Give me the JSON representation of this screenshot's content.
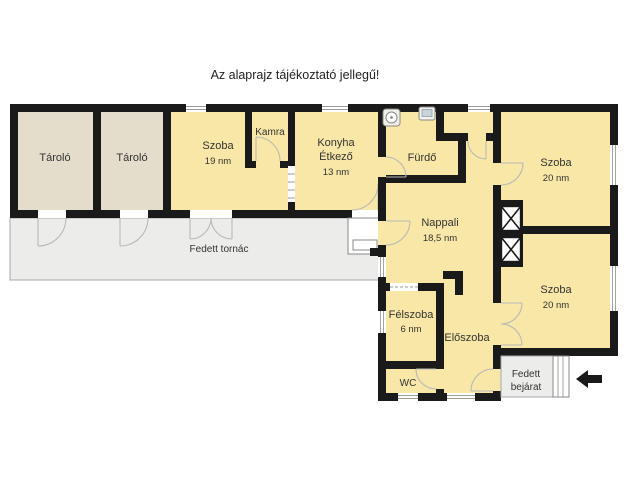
{
  "title": "Az alaprajz tájékoztató jellegű!",
  "colors": {
    "wall": "#1a1a1a",
    "room_yellow": "#f8e7a6",
    "storage_beige": "#e4ddcc",
    "covered_grey": "#ececea",
    "outline_grey": "#a9a9a9",
    "background": "#ffffff"
  },
  "rooms": {
    "tarolo_a": {
      "name": "Tároló"
    },
    "tarolo_b": {
      "name": "Tároló"
    },
    "szoba_19": {
      "name": "Szoba",
      "area": "19 nm"
    },
    "kamra": {
      "name": "Kamra"
    },
    "konyha": {
      "line1": "Konyha",
      "line2": "Étkező",
      "line3": "13 nm"
    },
    "furdo": {
      "name": "Fürdő"
    },
    "szoba_felso": {
      "name": "Szoba",
      "area": "20 nm"
    },
    "nappali": {
      "name": "Nappali",
      "area": "18,5 nm"
    },
    "szoba_also": {
      "name": "Szoba",
      "area": "20 nm"
    },
    "felszoba": {
      "name": "Félszoba",
      "area": "6 nm"
    },
    "eloszoba": {
      "name": "Előszoba"
    },
    "wc": {
      "name": "WC"
    }
  },
  "outdoor": {
    "tornac": "Fedett tornác",
    "bejarat_line1": "Fedett",
    "bejarat_line2": "bejárat"
  }
}
